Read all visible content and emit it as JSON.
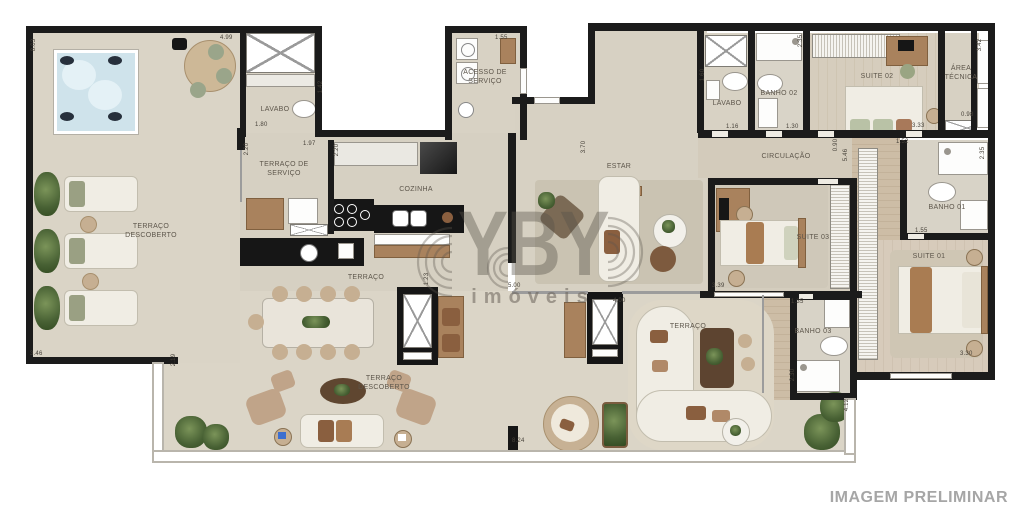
{
  "meta": {
    "disclaimer": "IMAGEM PRELIMINAR"
  },
  "watermark": {
    "brand": "YBY",
    "subtitle": "imóveis"
  },
  "colors": {
    "wall": "#1b1b1b",
    "floor": "#d8d2c4",
    "terrace_floor": "#dbd5c7",
    "counter_black": "#161616",
    "wood": "#a9825d",
    "hot_tub": "#cfe3eb",
    "watermark_gray": "#5a524a",
    "disclaimer_gray": "#a6a6a6"
  },
  "rooms": [
    {
      "id": "lavabo-esq",
      "label": "LAVABO"
    },
    {
      "id": "terraco-servico",
      "label": "TERRAÇO DE SERVIÇO"
    },
    {
      "id": "cozinha",
      "label": "COZINHA"
    },
    {
      "id": "acesso-servico",
      "label": "ACESSO DE SERVIÇO"
    },
    {
      "id": "estar",
      "label": "ESTAR"
    },
    {
      "id": "terraco-descoberto-esq",
      "label": "TERRAÇO DESCOBERTO"
    },
    {
      "id": "terraco-jantar",
      "label": "TERRAÇO"
    },
    {
      "id": "terraco-descoberto-inf",
      "label": "TERRAÇO DESCOBERTO"
    },
    {
      "id": "terraco-lounge",
      "label": "TERRAÇO"
    },
    {
      "id": "circulacao",
      "label": "CIRCULAÇÃO"
    },
    {
      "id": "lavabo-dir",
      "label": "LAVABO"
    },
    {
      "id": "banho-02",
      "label": "BANHO 02"
    },
    {
      "id": "suite-02",
      "label": "SUITE 02"
    },
    {
      "id": "area-tecnica",
      "label": "ÁREA TÉCNICA"
    },
    {
      "id": "banho-01",
      "label": "BANHO 01"
    },
    {
      "id": "suite-03",
      "label": "SUITE 03"
    },
    {
      "id": "suite-01",
      "label": "SUITE 01"
    },
    {
      "id": "banho-03",
      "label": "BANHO 03"
    }
  ],
  "dims": [
    "8.03",
    "4.99",
    "1.42",
    "1.80",
    "2.20",
    "1.97",
    "2.20",
    "1.55",
    "3.70",
    "1.60",
    "1.16",
    "1.30",
    "2.35",
    "3.33",
    "0.98",
    "3.42",
    "0.90",
    "5.46",
    "1.52",
    "2.35",
    "1.55",
    "3.39",
    "5.00",
    "4.00",
    "1.23",
    "1.35",
    "2.30",
    "4.12",
    "3.30",
    "3.46",
    "2.19",
    "8.24"
  ]
}
